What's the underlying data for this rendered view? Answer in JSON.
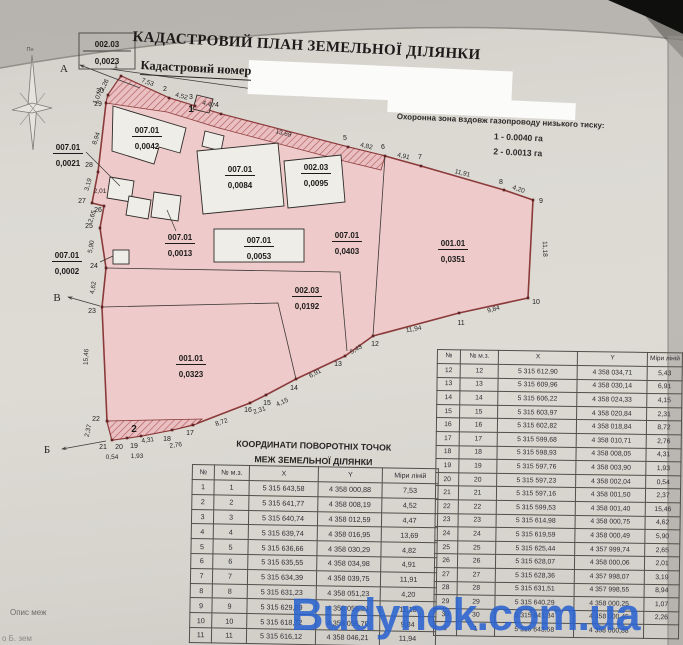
{
  "header": {
    "title": "КАДАСТРОВИЙ ПЛАН ЗЕМЕЛЬНОЇ ДІЛЯНКИ",
    "cadastral_number_label": "Кадастровий номер"
  },
  "protection_zone": {
    "title": "Охоронна зона вздовж газопроводу низького тиску:",
    "item1": "1 - 0.0040 га",
    "item2": "2 - 0.0013 га"
  },
  "compass": {
    "north_label": "Пн"
  },
  "plan": {
    "callout": {
      "code": "002.03",
      "area": "0,0023"
    },
    "direction_labels": [
      {
        "t": "А",
        "x": 64,
        "y": 72
      },
      {
        "t": "В",
        "x": 57,
        "y": 301
      },
      {
        "t": "Б",
        "x": 47,
        "y": 453
      }
    ],
    "zone_markers": [
      {
        "t": "1",
        "x": 191,
        "y": 112
      },
      {
        "t": "2",
        "x": 134,
        "y": 432
      }
    ],
    "vertices": [
      {
        "n": "1",
        "x": 121,
        "y": 76,
        "lx": 116,
        "ly": 68
      },
      {
        "n": "2",
        "x": 169,
        "y": 98,
        "lx": 165,
        "ly": 91
      },
      {
        "n": "3",
        "x": 195,
        "y": 106,
        "lx": 191,
        "ly": 99
      },
      {
        "n": "4",
        "x": 221,
        "y": 114,
        "lx": 217,
        "ly": 107
      },
      {
        "n": "5",
        "x": 348,
        "y": 147,
        "lx": 345,
        "ly": 140
      },
      {
        "n": "6",
        "x": 385,
        "y": 156,
        "lx": 383,
        "ly": 149
      },
      {
        "n": "7",
        "x": 421,
        "y": 166,
        "lx": 420,
        "ly": 159
      },
      {
        "n": "8",
        "x": 504,
        "y": 190,
        "lx": 501,
        "ly": 184
      },
      {
        "n": "9",
        "x": 533,
        "y": 200,
        "lx": 541,
        "ly": 203
      },
      {
        "n": "10",
        "x": 528,
        "y": 298,
        "lx": 536,
        "ly": 304
      },
      {
        "n": "11",
        "x": 459,
        "y": 313,
        "lx": 461,
        "ly": 325
      },
      {
        "n": "12",
        "x": 373,
        "y": 336,
        "lx": 375,
        "ly": 346
      },
      {
        "n": "13",
        "x": 345,
        "y": 356,
        "lx": 338,
        "ly": 366
      },
      {
        "n": "14",
        "x": 296,
        "y": 379,
        "lx": 294,
        "ly": 390
      },
      {
        "n": "15",
        "x": 266,
        "y": 395,
        "lx": 267,
        "ly": 405
      },
      {
        "n": "16",
        "x": 250,
        "y": 403,
        "lx": 248,
        "ly": 412
      },
      {
        "n": "17",
        "x": 193,
        "y": 425,
        "lx": 190,
        "ly": 435
      },
      {
        "n": "18",
        "x": 172,
        "y": 430,
        "lx": 167,
        "ly": 441
      },
      {
        "n": "19",
        "x": 141,
        "y": 436,
        "lx": 134,
        "ly": 448
      },
      {
        "n": "20",
        "x": 127,
        "y": 438,
        "lx": 119,
        "ly": 449
      },
      {
        "n": "21",
        "x": 112,
        "y": 440,
        "lx": 103,
        "ly": 449
      },
      {
        "n": "22",
        "x": 107,
        "y": 421,
        "lx": 96,
        "ly": 421
      },
      {
        "n": "23",
        "x": 102,
        "y": 307,
        "lx": 92,
        "ly": 313
      },
      {
        "n": "24",
        "x": 106,
        "y": 268,
        "lx": 94,
        "ly": 268
      },
      {
        "n": "25",
        "x": 100,
        "y": 228,
        "lx": 89,
        "ly": 228
      },
      {
        "n": "26",
        "x": 104,
        "y": 206,
        "lx": 98,
        "ly": 212
      },
      {
        "n": "27",
        "x": 92,
        "y": 203,
        "lx": 82,
        "ly": 203
      },
      {
        "n": "28",
        "x": 98,
        "y": 172,
        "lx": 89,
        "ly": 167
      },
      {
        "n": "29",
        "x": 106,
        "y": 103,
        "lx": 98,
        "ly": 106
      },
      {
        "n": "30",
        "x": 108,
        "y": 95,
        "lx": 100,
        "ly": 93
      }
    ],
    "edge_labels": [
      {
        "t": "7,53",
        "x": 147,
        "y": 84,
        "r": 20
      },
      {
        "t": "4,52",
        "x": 181,
        "y": 98,
        "r": 15
      },
      {
        "t": "4,47",
        "x": 208,
        "y": 106,
        "r": 15
      },
      {
        "t": "13,69",
        "x": 283,
        "y": 135,
        "r": 14
      },
      {
        "t": "4,82",
        "x": 366,
        "y": 148,
        "r": 13
      },
      {
        "t": "4,91",
        "x": 403,
        "y": 158,
        "r": 13
      },
      {
        "t": "11,91",
        "x": 462,
        "y": 175,
        "r": 14
      },
      {
        "t": "4,20",
        "x": 518,
        "y": 191,
        "r": 18
      },
      {
        "t": "11,18",
        "x": 543,
        "y": 249,
        "r": 88
      },
      {
        "t": "9,84",
        "x": 494,
        "y": 311,
        "r": -15
      },
      {
        "t": "11,94",
        "x": 414,
        "y": 331,
        "r": -10
      },
      {
        "t": "5,43",
        "x": 357,
        "y": 351,
        "r": -30
      },
      {
        "t": "6,91",
        "x": 316,
        "y": 375,
        "r": -28
      },
      {
        "t": "4,15",
        "x": 283,
        "y": 404,
        "r": -25
      },
      {
        "t": "2,31",
        "x": 260,
        "y": 412,
        "r": -18
      },
      {
        "t": "8,72",
        "x": 222,
        "y": 424,
        "r": -18
      },
      {
        "t": "2,76",
        "x": 176,
        "y": 447,
        "r": -8
      },
      {
        "t": "4,31",
        "x": 148,
        "y": 442,
        "r": -8
      },
      {
        "t": "1,93",
        "x": 137,
        "y": 458,
        "r": 0
      },
      {
        "t": "0,54",
        "x": 112,
        "y": 459,
        "r": 0
      },
      {
        "t": "2,37",
        "x": 90,
        "y": 431,
        "r": -78
      },
      {
        "t": "15,46",
        "x": 88,
        "y": 357,
        "r": -87
      },
      {
        "t": "4,62",
        "x": 95,
        "y": 288,
        "r": -80
      },
      {
        "t": "5,90",
        "x": 93,
        "y": 247,
        "r": -80
      },
      {
        "t": "2,65",
        "x": 94,
        "y": 217,
        "r": -72
      },
      {
        "t": "2,01",
        "x": 100,
        "y": 193,
        "r": 0
      },
      {
        "t": "3,19",
        "x": 90,
        "y": 185,
        "r": -75
      },
      {
        "t": "8,94",
        "x": 98,
        "y": 139,
        "r": -70
      },
      {
        "t": "1,07",
        "x": 99,
        "y": 99,
        "r": -62
      },
      {
        "t": "2,26",
        "x": 106,
        "y": 86,
        "r": -62
      }
    ],
    "area_labels": [
      {
        "code": "007.01",
        "area": "0,0042",
        "x": 147,
        "y": 133
      },
      {
        "code": "007.01",
        "area": "0,0084",
        "x": 240,
        "y": 172
      },
      {
        "code": "002.03",
        "area": "0,0095",
        "x": 316,
        "y": 170
      },
      {
        "code": "007.01",
        "area": "0,0021",
        "x": 68,
        "y": 150
      },
      {
        "code": "007.01",
        "area": "0,0013",
        "x": 180,
        "y": 240
      },
      {
        "code": "007.01",
        "area": "0,0053",
        "x": 259,
        "y": 243
      },
      {
        "code": "007.01",
        "area": "0,0403",
        "x": 347,
        "y": 238
      },
      {
        "code": "001.01",
        "area": "0,0351",
        "x": 453,
        "y": 246
      },
      {
        "code": "007.01",
        "area": "0,0002",
        "x": 67,
        "y": 258
      },
      {
        "code": "002.03",
        "area": "0,0192",
        "x": 307,
        "y": 293
      },
      {
        "code": "001.01",
        "area": "0,0323",
        "x": 191,
        "y": 361
      }
    ]
  },
  "coords_table": {
    "title_line1": "КООРДИНАТИ ПОВОРОТНІХ ТОЧОК",
    "title_line2": "МЕЖ ЗЕМЕЛЬНОЇ ДІЛЯНКИ",
    "headers": [
      "№",
      "№ м.з.",
      "X",
      "Y",
      "Міри ліній"
    ],
    "rows_1_11": [
      [
        "1",
        "1",
        "5 315 643,58",
        "4 358 000,88",
        "7,53"
      ],
      [
        "2",
        "2",
        "5 315 641,77",
        "4 358 008,19",
        "4,52"
      ],
      [
        "3",
        "3",
        "5 315 640,74",
        "4 358 012,59",
        "4,47"
      ],
      [
        "4",
        "4",
        "5 315 639,74",
        "4 358 016,95",
        "13,69"
      ],
      [
        "5",
        "5",
        "5 315 636,66",
        "4 358 030,29",
        "4,82"
      ],
      [
        "6",
        "6",
        "5 315 635,55",
        "4 358 034,98",
        "4,91"
      ],
      [
        "7",
        "7",
        "5 315 634,39",
        "4 358 039,75",
        "11,91"
      ],
      [
        "8",
        "8",
        "5 315 631,23",
        "4 358 051,23",
        "4,20"
      ],
      [
        "9",
        "9",
        "5 315 629,89",
        "4 358 055,21",
        "11,18"
      ],
      [
        "10",
        "10",
        "5 315 618,72",
        "4 358 055,70",
        "9,84"
      ],
      [
        "11",
        "11",
        "5 315 616,12",
        "4 358 046,21",
        "11,94"
      ]
    ],
    "rows_12_30": [
      [
        "12",
        "12",
        "5 315 612,90",
        "4 358 034,71",
        "5,43"
      ],
      [
        "13",
        "13",
        "5 315 609,96",
        "4 358 030,14",
        "6,91"
      ],
      [
        "14",
        "14",
        "5 315 606,22",
        "4 358 024,33",
        "4,15"
      ],
      [
        "15",
        "15",
        "5 315 603,97",
        "4 358 020,84",
        "2,31"
      ],
      [
        "16",
        "16",
        "5 315 602,82",
        "4 358 018,84",
        "8,72"
      ],
      [
        "17",
        "17",
        "5 315 599,68",
        "4 358 010,71",
        "2,76"
      ],
      [
        "18",
        "18",
        "5 315 598,93",
        "4 358 008,05",
        "4,31"
      ],
      [
        "19",
        "19",
        "5 315 597,76",
        "4 358 003,90",
        "1,93"
      ],
      [
        "20",
        "20",
        "5 315 597,23",
        "4 358 002,04",
        "0,54"
      ],
      [
        "21",
        "21",
        "5 315 597,16",
        "4 358 001,50",
        "2,37"
      ],
      [
        "22",
        "22",
        "5 315 599,53",
        "4 358 001,40",
        "15,46"
      ],
      [
        "23",
        "23",
        "5 315 614,98",
        "4 358 000,75",
        "4,62"
      ],
      [
        "24",
        "24",
        "5 315 619,59",
        "4 358 000,49",
        "5,90"
      ],
      [
        "25",
        "25",
        "5 315 625,44",
        "4 357 999,74",
        "2,65"
      ],
      [
        "26",
        "26",
        "5 315 628,07",
        "4 358 000,06",
        "2,01"
      ],
      [
        "27",
        "27",
        "5 315 628,36",
        "4 357 998,07",
        "3,19"
      ],
      [
        "28",
        "28",
        "5 315 631,51",
        "4 357 998,55",
        "8,94"
      ],
      [
        "29",
        "29",
        "5 315 640,29",
        "4 358 000,25",
        "1,07"
      ],
      [
        "30",
        "30",
        "5 315 641,34",
        "4 358 000,45",
        "2,26"
      ],
      [
        "1",
        "1",
        "5 315 643,58",
        "4 358 000,88",
        ""
      ]
    ]
  },
  "notes": {
    "line1": "Опис меж",
    "line2": "о Б. зем"
  },
  "watermark": "Budynok.com.ua",
  "colors": {
    "parcel_fill": "#eecaca",
    "parcel_stroke": "#8b3a3a",
    "watermark": "#2a63cf"
  }
}
